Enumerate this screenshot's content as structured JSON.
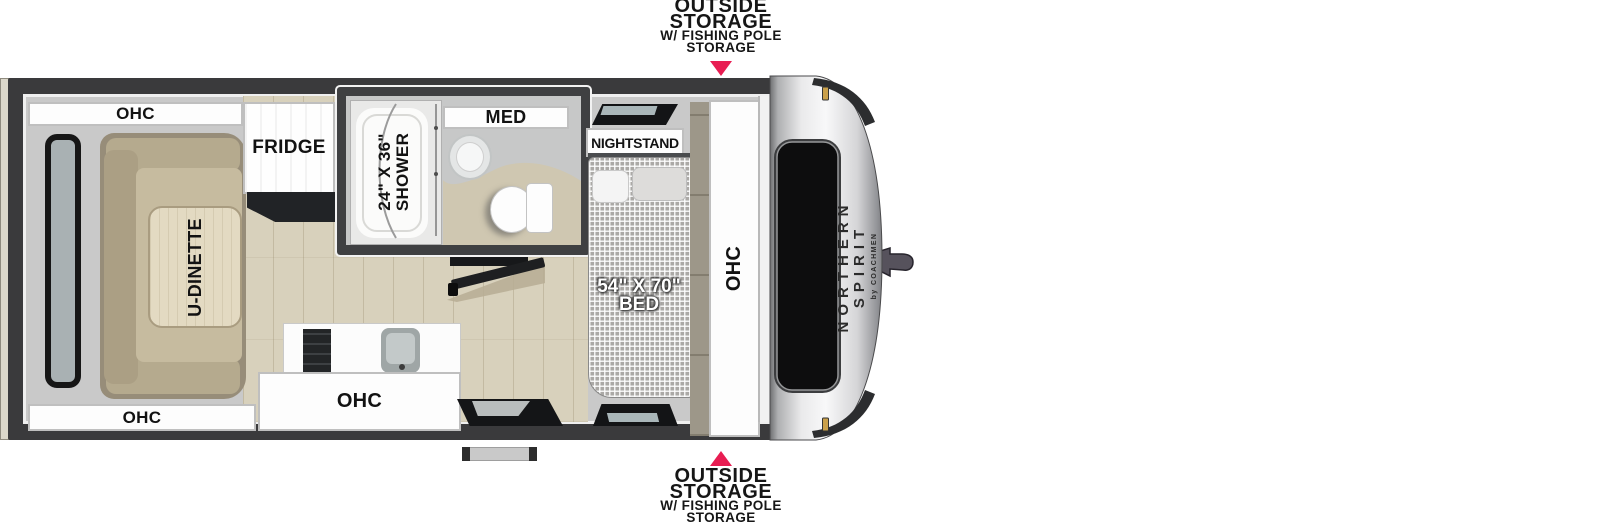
{
  "callouts": {
    "top": {
      "line1": "OUTSIDE",
      "line2": "STORAGE",
      "line3": "W/ FISHING POLE",
      "line4": "STORAGE"
    },
    "bottom": {
      "line1": "OUTSIDE",
      "line2": "STORAGE",
      "line3": "W/ FISHING POLE",
      "line4": "STORAGE"
    }
  },
  "labels": {
    "ohc_dinette_top": "OHC",
    "ohc_dinette_bottom": "OHC",
    "fridge": "FRIDGE",
    "dinette_table": "U-DINETTE",
    "ohc_kitchen": "OHC",
    "shower_size": "24\" X 36\"",
    "shower": "SHOWER",
    "med": "MED",
    "nightstand": "NIGHTSTAND",
    "bed_size": "54\" X 70\"",
    "bed": "BED",
    "ohc_bedroom": "OHC"
  },
  "branding": {
    "model_line1": "NORTHERN",
    "model_line2": "SPIRIT",
    "byline": "by COACHMEN"
  },
  "colors": {
    "callout_arrow": "#e81d52",
    "wall": "#3a3a3c",
    "floor_wood": "#d8d1bc",
    "sofa_tan": "#b5aa8e",
    "bed_check": "#aba9a6",
    "nose_silver": "#e8e8e9",
    "marker_amber": "#caa04a"
  }
}
